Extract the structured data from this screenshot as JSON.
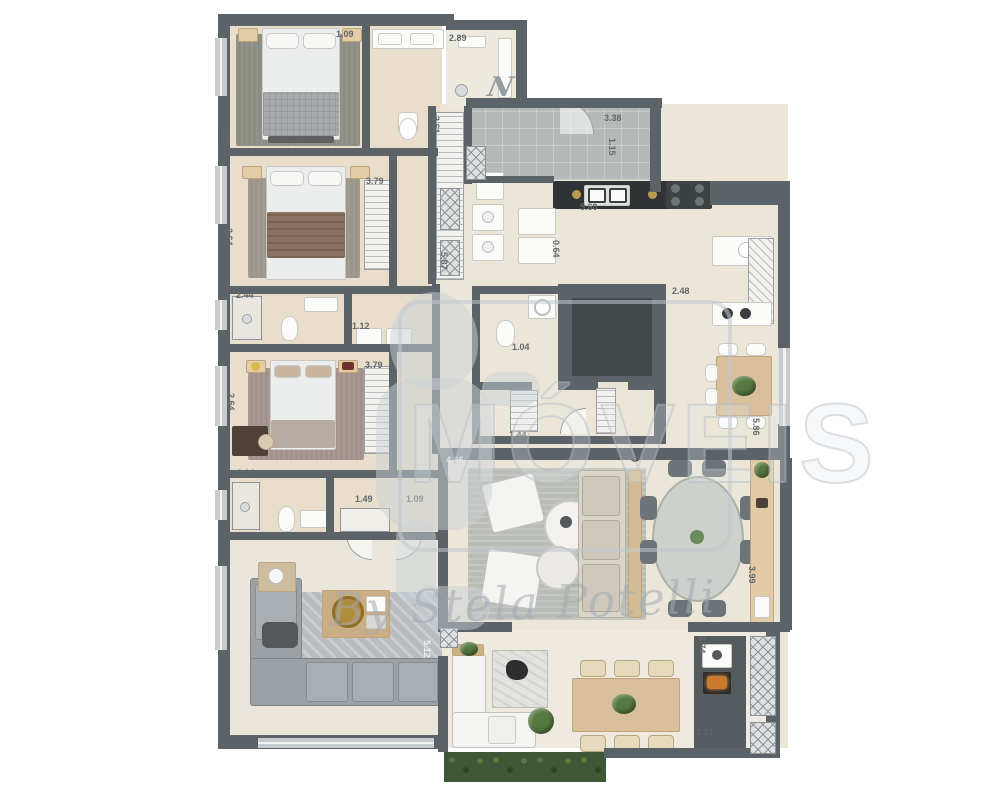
{
  "watermark": {
    "letters": "MÓVEIS",
    "signature": "By Stela Potelli",
    "north_mark": "N"
  },
  "palette": {
    "wall": "#5b6268",
    "floor": "#ece6d9",
    "warm_floor": "#e9decb",
    "hall_floor": "#b5b9b8",
    "dark_room_floor": "#43484b",
    "counter_black": "#2f3335",
    "wood_accent": "#d9c09a",
    "greenery": "#577a42",
    "grill_ember": "#c97a2e",
    "label_text": "#63686c"
  },
  "dimensions": [
    {
      "text": "1.09",
      "x": 336,
      "y": 29,
      "rot": 0
    },
    {
      "text": "2.89",
      "x": 449,
      "y": 33,
      "rot": 0
    },
    {
      "text": "3.29",
      "x": 231,
      "y": 128,
      "rot": 90
    },
    {
      "text": "2.64",
      "x": 234,
      "y": 228,
      "rot": 90
    },
    {
      "text": "3.79",
      "x": 366,
      "y": 176,
      "rot": 0
    },
    {
      "text": "3.61",
      "x": 441,
      "y": 116,
      "rot": 90
    },
    {
      "text": "5.87",
      "x": 449,
      "y": 252,
      "rot": 90
    },
    {
      "text": "3.38",
      "x": 604,
      "y": 113,
      "rot": 0
    },
    {
      "text": "1.15",
      "x": 617,
      "y": 138,
      "rot": 90
    },
    {
      "text": "5.60",
      "x": 580,
      "y": 202,
      "rot": 0
    },
    {
      "text": "0.64",
      "x": 561,
      "y": 240,
      "rot": 90
    },
    {
      "text": "2.48",
      "x": 672,
      "y": 286,
      "rot": 0
    },
    {
      "text": "5.86",
      "x": 761,
      "y": 418,
      "rot": 90
    },
    {
      "text": "1.04",
      "x": 512,
      "y": 342,
      "rot": 0
    },
    {
      "text": "1.44",
      "x": 509,
      "y": 430,
      "rot": 0
    },
    {
      "text": "1.12",
      "x": 352,
      "y": 321,
      "rot": 0
    },
    {
      "text": "2.44",
      "x": 236,
      "y": 290,
      "rot": 0
    },
    {
      "text": "3.79",
      "x": 365,
      "y": 360,
      "rot": 0
    },
    {
      "text": "2.64",
      "x": 236,
      "y": 393,
      "rot": 90
    },
    {
      "text": "2.04",
      "x": 237,
      "y": 468,
      "rot": 0
    },
    {
      "text": "1.49",
      "x": 355,
      "y": 494,
      "rot": 0
    },
    {
      "text": "1.09",
      "x": 406,
      "y": 494,
      "rot": 0
    },
    {
      "text": "4.46",
      "x": 446,
      "y": 455,
      "rot": 0,
      "light": true
    },
    {
      "text": "5.12",
      "x": 432,
      "y": 640,
      "rot": 90,
      "light": true
    },
    {
      "text": "3.99",
      "x": 757,
      "y": 566,
      "rot": 90
    },
    {
      "text": "2.74",
      "x": 707,
      "y": 636,
      "rot": 90
    },
    {
      "text": "2.31",
      "x": 696,
      "y": 727,
      "rot": 0
    }
  ]
}
